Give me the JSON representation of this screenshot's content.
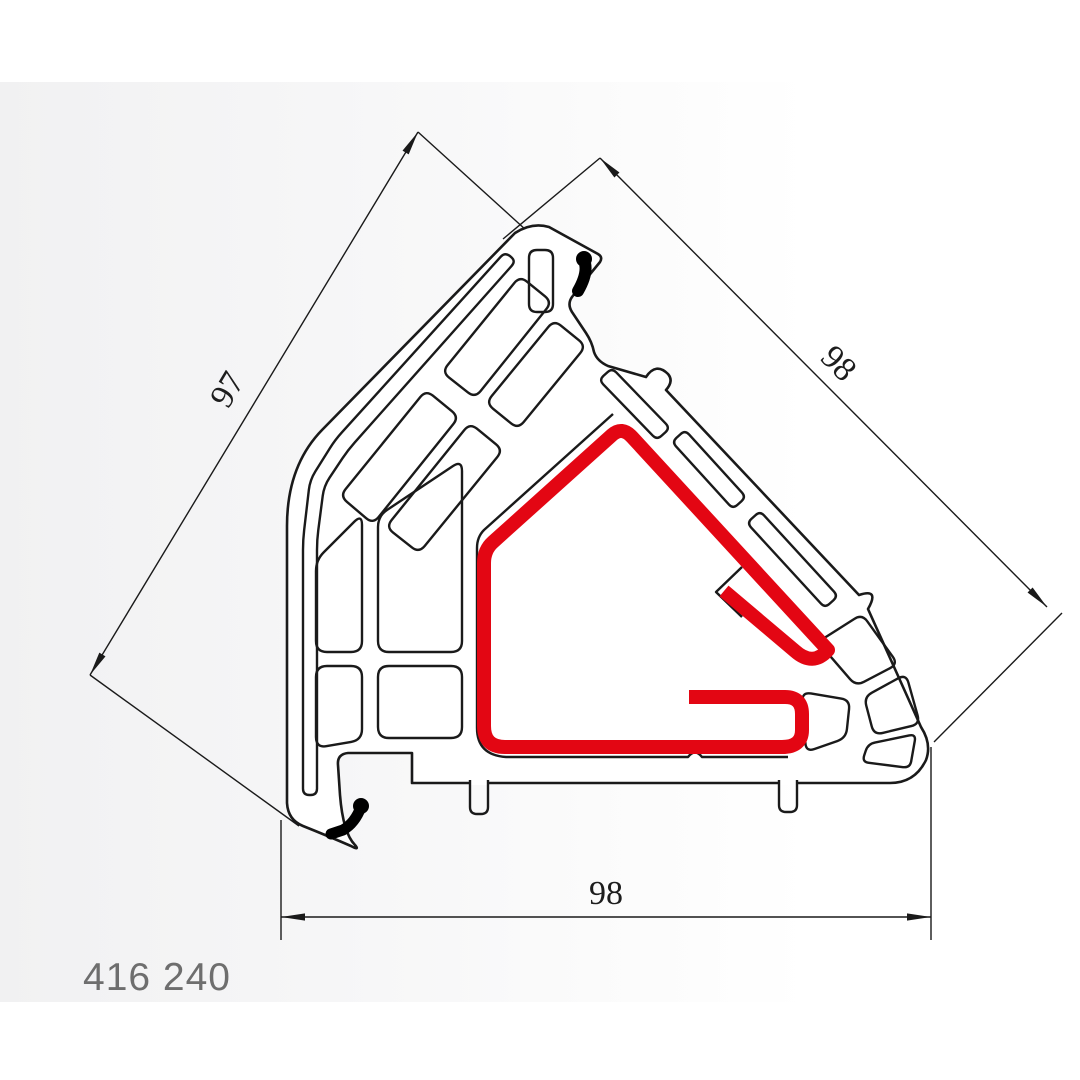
{
  "drawing": {
    "part_number": "416 240",
    "dimensions": {
      "left_edge": "97",
      "top_right_edge": "98",
      "bottom_edge": "98"
    }
  },
  "colors": {
    "highlight_red": "#e30613",
    "line_black": "#1a1a1a",
    "background_gray": "#f1f1f2",
    "label_gray": "#6e6e6e"
  }
}
